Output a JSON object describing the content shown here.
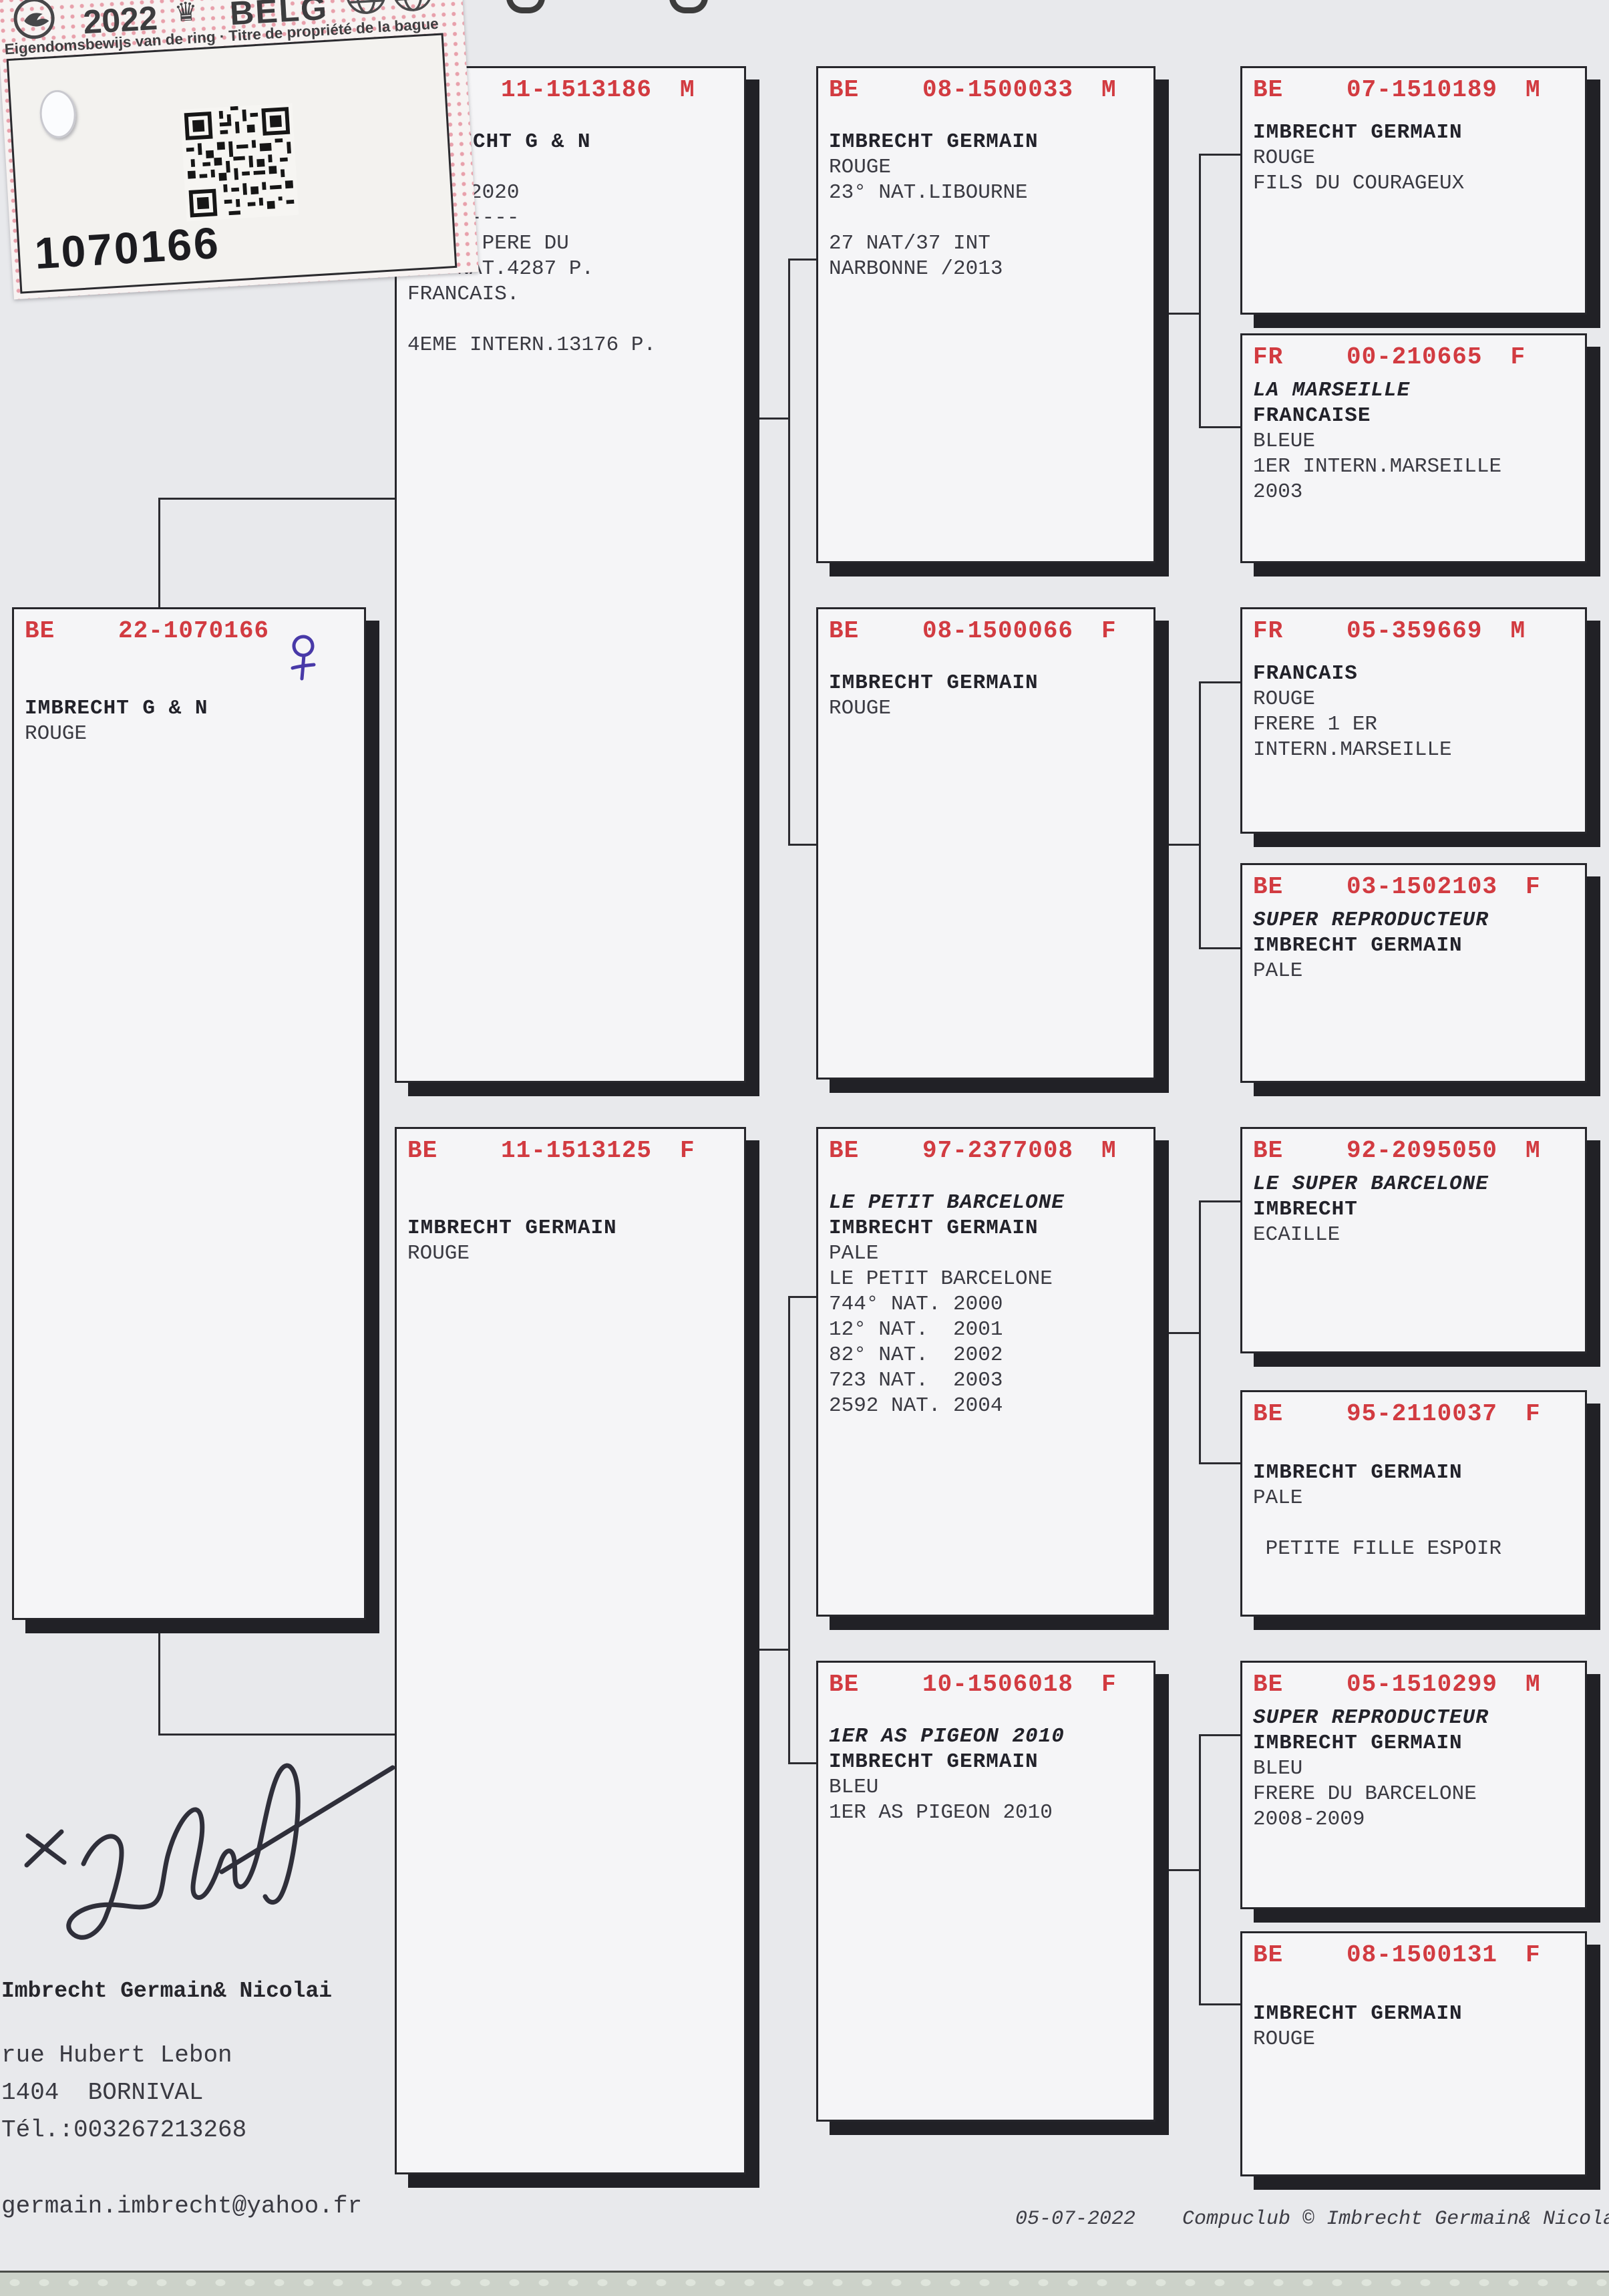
{
  "sticker": {
    "year": "2022",
    "country": "BELG",
    "subtitle": "Eigendomsbewijs van de ring · Titre de propriété de la bague",
    "ring_number": "1070166",
    "icons": [
      "dove-logo",
      "crown-icon",
      "globe-logos",
      "qr-code",
      "hole-punch"
    ],
    "colors": {
      "dot_pink": "#e8a0ab"
    }
  },
  "colors": {
    "header_red": "#d23b41",
    "ink_blue": "#4839a8",
    "ink_black": "#2f2f3a"
  },
  "handwriting": {
    "sex_mark": "female-symbol",
    "signature": "owner-signature"
  },
  "boxes": {
    "b22": {
      "country": "BE",
      "id": "22-1070166",
      "sex": "",
      "lines": [
        {
          "s": "sp"
        },
        {
          "t": "IMBRECHT G & N",
          "s": "b"
        },
        {
          "t": "ROUGE",
          "s": "r"
        }
      ]
    },
    "b186": {
      "country": "BE",
      "id": "11-1513186",
      "sex": "M",
      "lines": [
        {
          "t": "IMBRECHT G & N",
          "s": "b"
        },
        {
          "t": "ROUGE",
          "s": "r"
        },
        {
          "t": "     2020",
          "s": "r"
        },
        {
          "t": "  -------",
          "s": "r"
        },
        {
          "t": "GRAND PERE DU",
          "s": "r"
        },
        {
          "t": "1ER NAT.4287 P.",
          "s": "r"
        },
        {
          "t": "FRANCAIS.",
          "s": "r"
        },
        {
          "s": "sp"
        },
        {
          "t": "4EME INTERN.13176 P.",
          "s": "r"
        }
      ]
    },
    "b125": {
      "country": "BE",
      "id": "11-1513125",
      "sex": "F",
      "lines": [
        {
          "s": "sp"
        },
        {
          "t": "IMBRECHT GERMAIN",
          "s": "b"
        },
        {
          "t": "ROUGE",
          "s": "r"
        }
      ]
    },
    "b033": {
      "country": "BE",
      "id": "08-1500033",
      "sex": "M",
      "lines": [
        {
          "t": "IMBRECHT GERMAIN",
          "s": "b"
        },
        {
          "t": "ROUGE",
          "s": "r"
        },
        {
          "t": "23° NAT.LIBOURNE",
          "s": "r"
        },
        {
          "s": "sp"
        },
        {
          "t": "27 NAT/37 INT",
          "s": "r"
        },
        {
          "t": "NARBONNE /2013",
          "s": "r"
        }
      ]
    },
    "b066": {
      "country": "BE",
      "id": "08-1500066",
      "sex": "F",
      "lines": [
        {
          "t": "IMBRECHT GERMAIN",
          "s": "b"
        },
        {
          "t": "ROUGE",
          "s": "r"
        }
      ]
    },
    "b008": {
      "country": "BE",
      "id": "97-2377008",
      "sex": "M",
      "lines": [
        {
          "t": "LE PETIT BARCELONE",
          "s": "bi"
        },
        {
          "t": "IMBRECHT GERMAIN",
          "s": "b"
        },
        {
          "t": "PALE",
          "s": "r"
        },
        {
          "t": "LE PETIT BARCELONE",
          "s": "r"
        },
        {
          "t": "744° NAT. 2000",
          "s": "r"
        },
        {
          "t": "12° NAT.  2001",
          "s": "r"
        },
        {
          "t": "82° NAT.  2002",
          "s": "r"
        },
        {
          "t": "723 NAT.  2003",
          "s": "r"
        },
        {
          "t": "2592 NAT. 2004",
          "s": "r"
        }
      ]
    },
    "b018": {
      "country": "BE",
      "id": "10-1506018",
      "sex": "F",
      "lines": [
        {
          "t": "1ER AS PIGEON 2010",
          "s": "bi"
        },
        {
          "t": "IMBRECHT GERMAIN",
          "s": "b"
        },
        {
          "t": "BLEU",
          "s": "r"
        },
        {
          "t": "1ER AS PIGEON 2010",
          "s": "r"
        }
      ]
    },
    "b189": {
      "country": "BE",
      "id": "07-1510189",
      "sex": "M",
      "lines": [
        {
          "t": "IMBRECHT GERMAIN",
          "s": "b"
        },
        {
          "t": "ROUGE",
          "s": "r"
        },
        {
          "t": "FILS DU COURAGEUX",
          "s": "r"
        }
      ]
    },
    "b665": {
      "country": "FR",
      "id": "00-210665",
      "sex": "F",
      "lines": [
        {
          "t": "LA MARSEILLE",
          "s": "bi"
        },
        {
          "t": "FRANCAISE",
          "s": "b"
        },
        {
          "t": "BLEUE",
          "s": "r"
        },
        {
          "t": "1ER INTERN.MARSEILLE",
          "s": "r"
        },
        {
          "t": "2003",
          "s": "r"
        }
      ]
    },
    "b669": {
      "country": "FR",
      "id": "05-359669",
      "sex": "M",
      "lines": [
        {
          "t": "FRANCAIS",
          "s": "b"
        },
        {
          "t": "ROUGE",
          "s": "r"
        },
        {
          "t": "FRERE 1 ER",
          "s": "r"
        },
        {
          "t": "INTERN.MARSEILLE",
          "s": "r"
        }
      ]
    },
    "b103": {
      "country": "BE",
      "id": "03-1502103",
      "sex": "F",
      "lines": [
        {
          "t": "SUPER REPRODUCTEUR",
          "s": "bi"
        },
        {
          "t": "IMBRECHT GERMAIN",
          "s": "b"
        },
        {
          "t": "PALE",
          "s": "r"
        }
      ]
    },
    "b050": {
      "country": "BE",
      "id": "92-2095050",
      "sex": "M",
      "lines": [
        {
          "t": "LE SUPER BARCELONE",
          "s": "bi"
        },
        {
          "t": "IMBRECHT",
          "s": "b"
        },
        {
          "t": "ECAILLE",
          "s": "r"
        }
      ]
    },
    "b037": {
      "country": "BE",
      "id": "95-2110037",
      "sex": "F",
      "lines": [
        {
          "s": "sp"
        },
        {
          "t": "IMBRECHT GERMAIN",
          "s": "b"
        },
        {
          "t": "PALE",
          "s": "r"
        },
        {
          "s": "sp"
        },
        {
          "t": " PETITE FILLE ESPOIR",
          "s": "r"
        }
      ]
    },
    "b299": {
      "country": "BE",
      "id": "05-1510299",
      "sex": "M",
      "lines": [
        {
          "t": "SUPER REPRODUCTEUR",
          "s": "bi"
        },
        {
          "t": "IMBRECHT GERMAIN",
          "s": "b"
        },
        {
          "t": "BLEU",
          "s": "r"
        },
        {
          "t": "FRERE DU BARCELONE",
          "s": "r"
        },
        {
          "t": "2008-2009",
          "s": "r"
        }
      ]
    },
    "b131": {
      "country": "BE",
      "id": "08-1500131",
      "sex": "F",
      "lines": [
        {
          "s": "sp"
        },
        {
          "t": "IMBRECHT GERMAIN",
          "s": "b"
        },
        {
          "t": "ROUGE",
          "s": "r"
        }
      ]
    }
  },
  "owner": {
    "name": "Imbrecht Germain& Nicolai",
    "address1": "rue Hubert Lebon",
    "address2": "1404  BORNIVAL",
    "phone": "Tél.:003267213268",
    "email": "germain.imbrecht@yahoo.fr"
  },
  "footer": {
    "date": "05-07-2022",
    "credit": "Compuclub © Imbrecht Germain& Nicolai"
  }
}
